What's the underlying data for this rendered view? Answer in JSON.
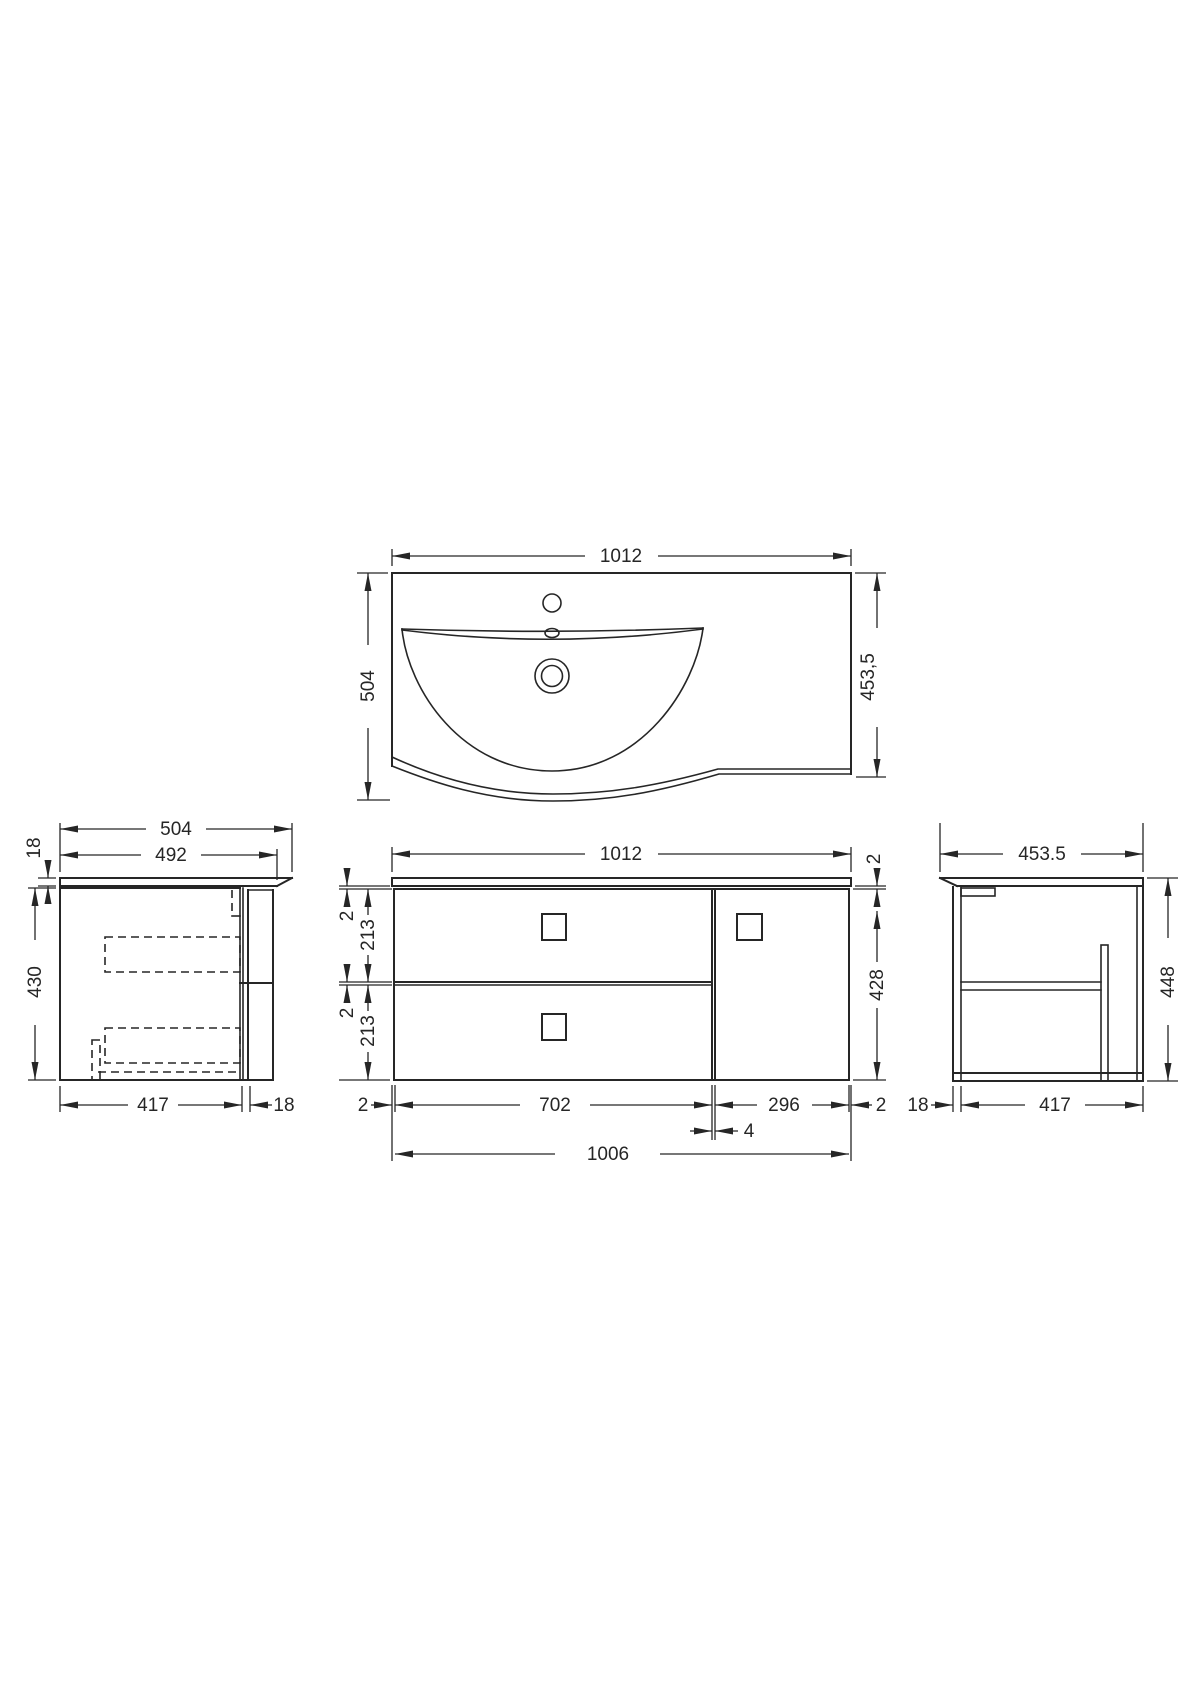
{
  "drawing": {
    "line_color": "#262626",
    "top_view": {
      "width": "1012",
      "depth_left": "504",
      "depth_right": "453,5"
    },
    "left_view": {
      "counter_depth": "504",
      "counter_depth_inner": "492",
      "counter_thickness": "18",
      "cabinet_height": "430",
      "cabinet_depth": "417",
      "front_panel": "18"
    },
    "front_view": {
      "counter_width": "1012",
      "counter_gap_right": "2",
      "top_gap": "2",
      "drawer1_height": "213",
      "mid_gap": "2",
      "drawer2_height": "213",
      "cabinet_height": "428",
      "side_gap_left": "2",
      "drawers_width": "702",
      "divider_gap": "4",
      "door_width": "296",
      "side_gap_right": "2",
      "cabinet_width": "1006"
    },
    "right_view": {
      "counter_depth": "453.5",
      "total_height": "448",
      "front_panel": "18",
      "cabinet_depth": "417"
    }
  }
}
